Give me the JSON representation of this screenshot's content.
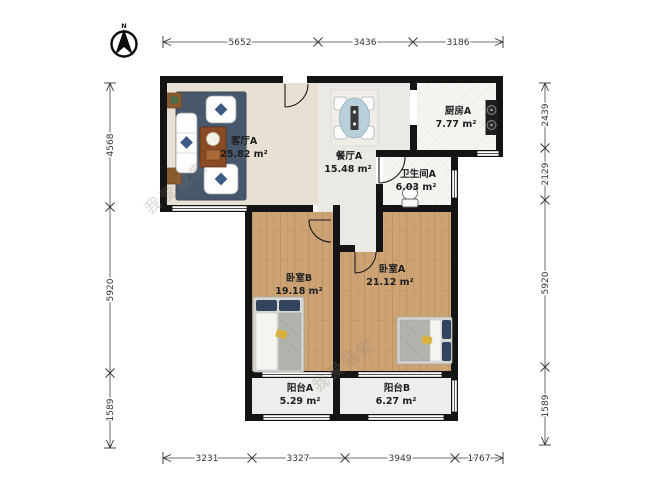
{
  "compass": {
    "label": "N"
  },
  "watermark": {
    "text": "我爱我家"
  },
  "rooms": {
    "living": {
      "name": "客厅A",
      "area": "25.82 m²"
    },
    "dining": {
      "name": "餐厅A",
      "area": "15.48 m²"
    },
    "kitchen": {
      "name": "厨房A",
      "area": "7.77 m²"
    },
    "bathroom": {
      "name": "卫生间A",
      "area": "6.03 m²"
    },
    "bedroom_b": {
      "name": "卧室B",
      "area": "19.18 m²"
    },
    "bedroom_a": {
      "name": "卧室A",
      "area": "21.12 m²"
    },
    "balcony_a": {
      "name": "阳台A",
      "area": "5.29 m²"
    },
    "balcony_b": {
      "name": "阳台B",
      "area": "6.27 m²"
    }
  },
  "dimensions_mm": {
    "top": [
      "5652",
      "3436",
      "3186"
    ],
    "bottom": [
      "3231",
      "3327",
      "3949",
      "1767"
    ],
    "left": [
      "4568",
      "5920",
      "1589"
    ],
    "right": [
      "2439",
      "2129",
      "5920",
      "1589"
    ]
  },
  "colors": {
    "wall": "#141414",
    "wood_floor": "#cda376",
    "living_floor": "#e8e1d3",
    "dining_floor": "#eae9e5",
    "tile_floor": "#f4f4f1",
    "balcony_floor": "#ededeb",
    "rug": "#47586c",
    "accent_navy": "#33455e",
    "accent_yellow": "#d8b13c"
  }
}
